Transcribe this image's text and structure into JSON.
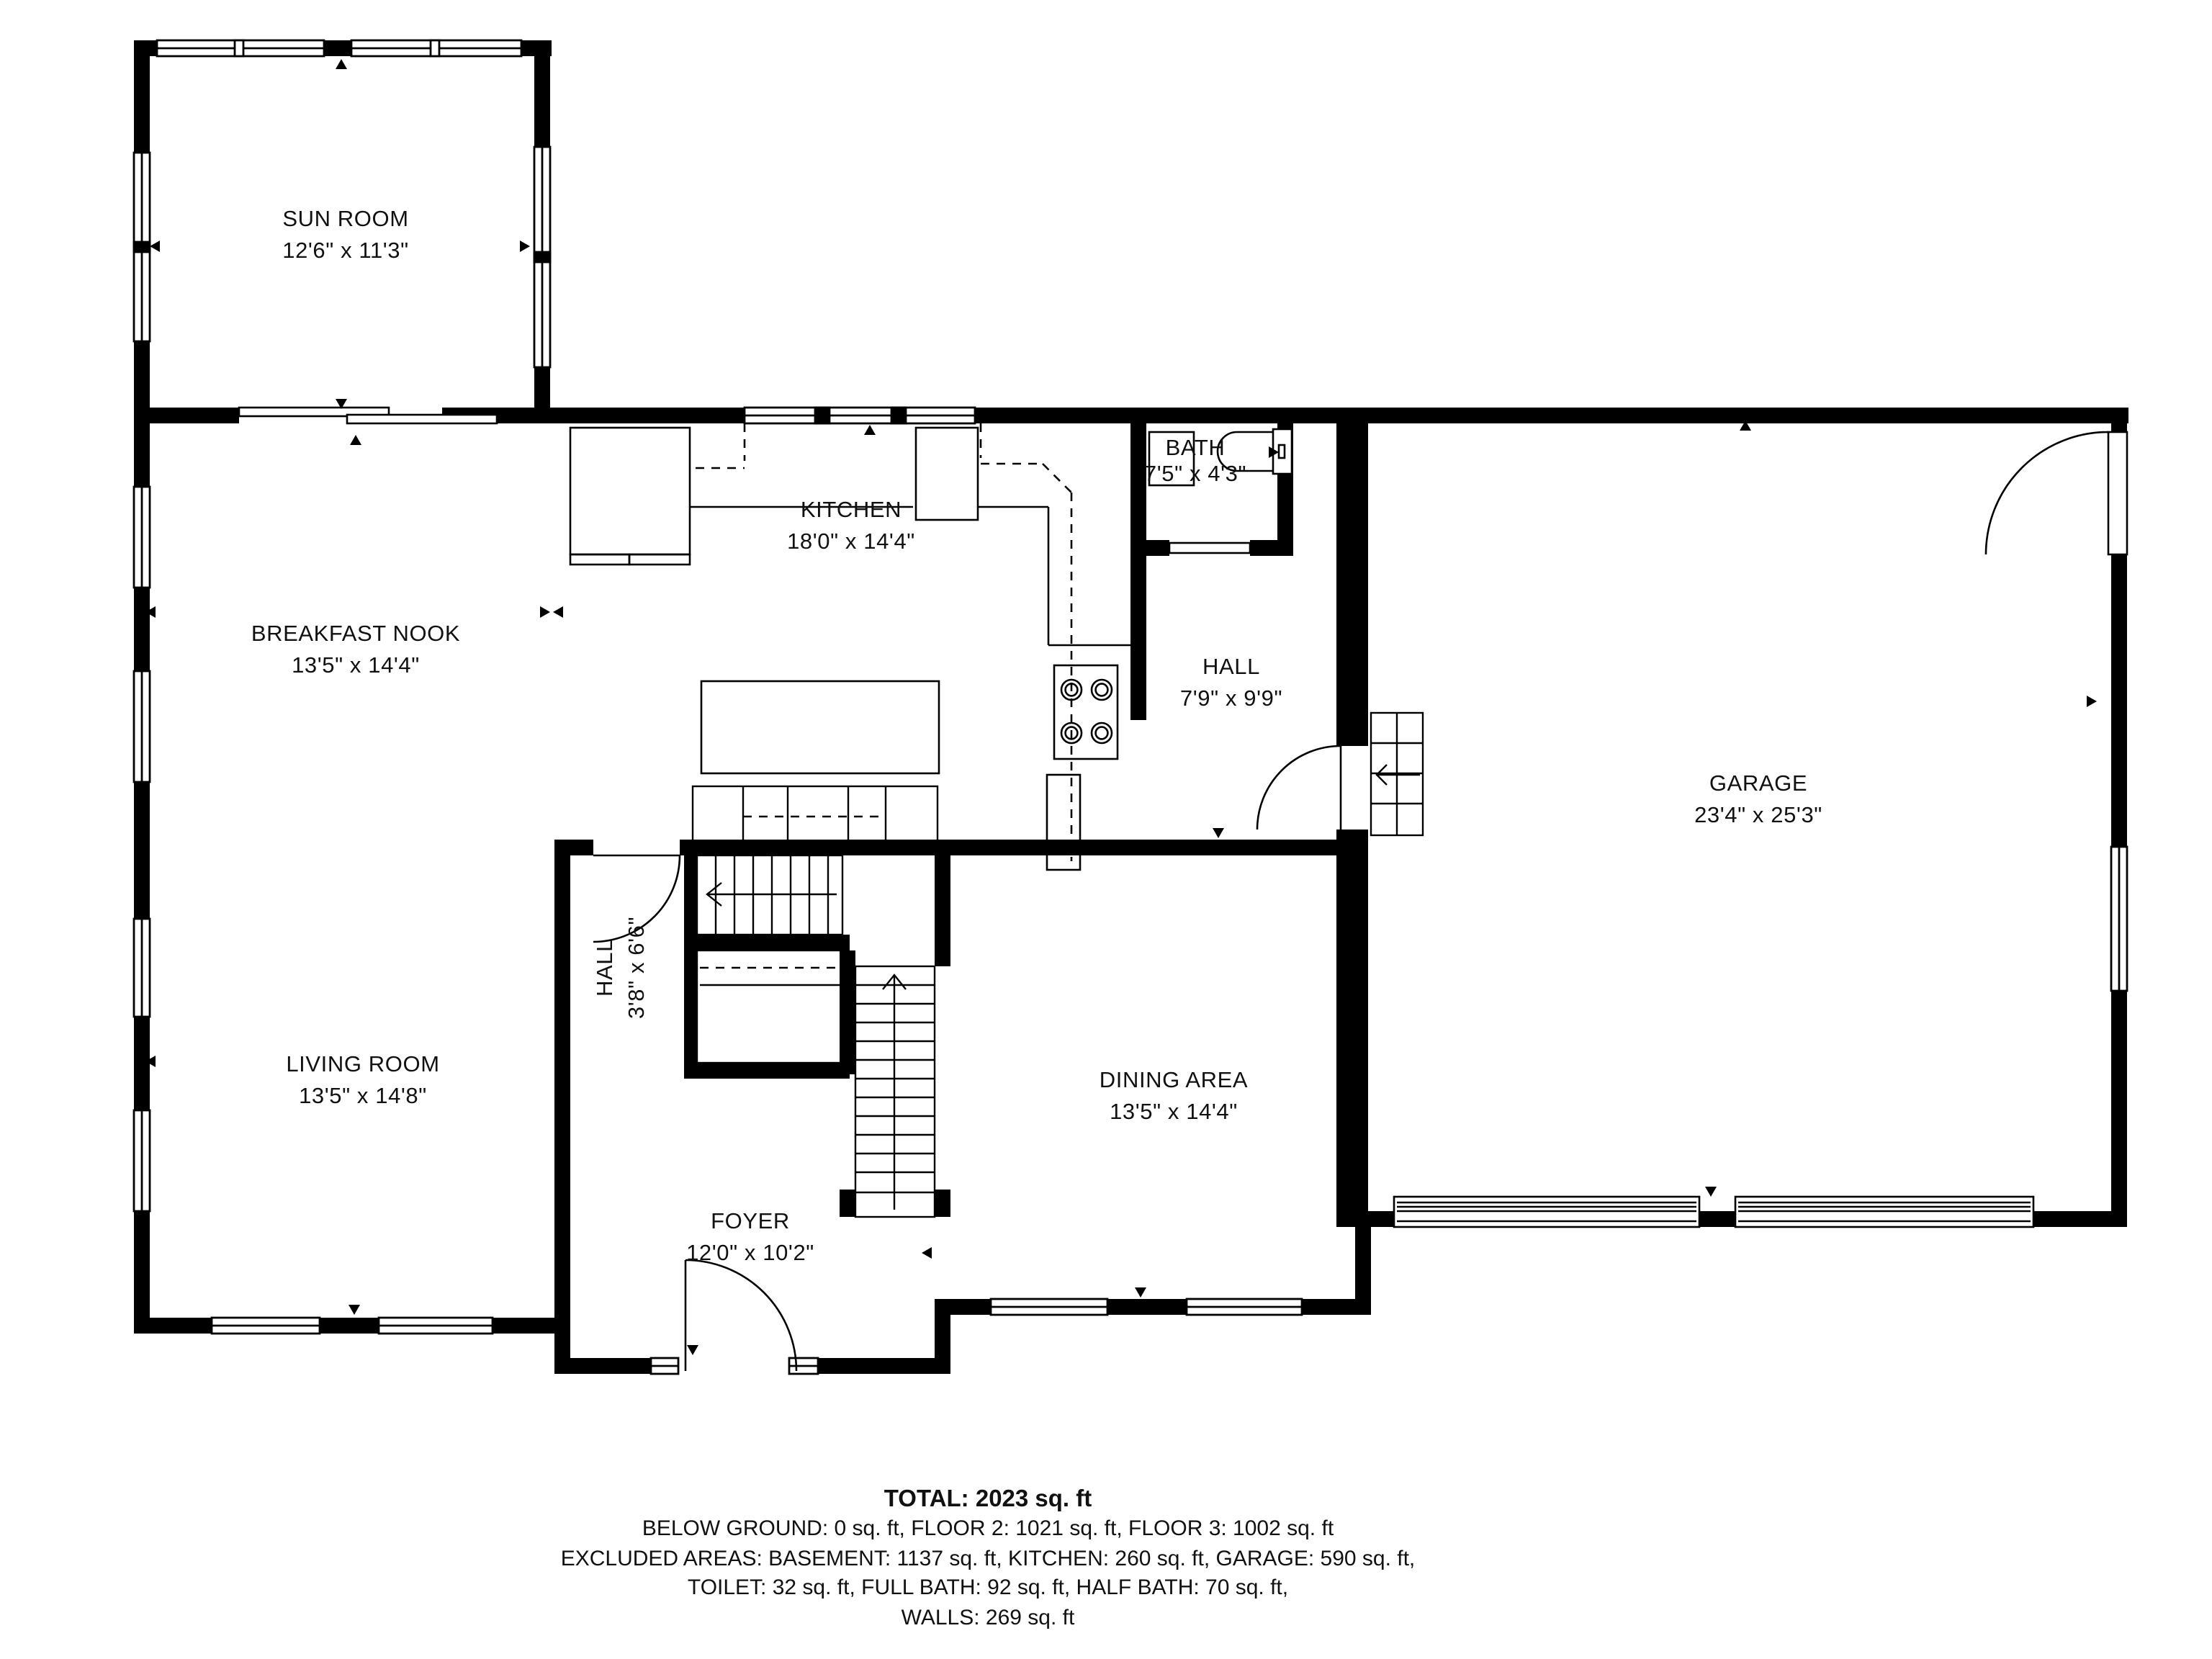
{
  "meta": {
    "app_name": "CubiCasa floor plan",
    "background_color": "#ffffff",
    "wall_color": "#000000",
    "text_color": "#111111"
  },
  "rooms": [
    {
      "id": "sun-room",
      "name": "SUN ROOM",
      "dims": "12'6\" x 11'3\""
    },
    {
      "id": "kitchen",
      "name": "KITCHEN",
      "dims": "18'0\" x 14'4\""
    },
    {
      "id": "bath",
      "name": "BATH",
      "dims": "7'5\" x 4'3\""
    },
    {
      "id": "breakfast-nook",
      "name": "BREAKFAST NOOK",
      "dims": "13'5\" x 14'4\""
    },
    {
      "id": "hall-upper",
      "name": "HALL",
      "dims": "7'9\" x 9'9\""
    },
    {
      "id": "garage",
      "name": "GARAGE",
      "dims": "23'4\" x 25'3\""
    },
    {
      "id": "living-room",
      "name": "LIVING ROOM",
      "dims": "13'5\" x 14'8\""
    },
    {
      "id": "hall-small",
      "name": "HALL",
      "dims": "3'8\" x 6'6\""
    },
    {
      "id": "dining-area",
      "name": "DINING AREA",
      "dims": "13'5\" x 14'4\""
    },
    {
      "id": "foyer",
      "name": "FOYER",
      "dims": "12'0\" x 10'2\""
    }
  ],
  "summary": {
    "total": "TOTAL: 2023 sq. ft",
    "line1": "BELOW GROUND: 0 sq. ft, FLOOR 2: 1021 sq. ft, FLOOR 3: 1002 sq. ft",
    "line2": "EXCLUDED AREAS: BASEMENT: 1137 sq. ft, KITCHEN: 260 sq. ft, GARAGE: 590 sq. ft,",
    "line3": "TOILET: 32 sq. ft, FULL BATH: 92 sq. ft, HALF BATH: 70 sq. ft,",
    "line4": "WALLS: 269 sq. ft",
    "disclaimer": "FLOOR PLAN CREATED BY CUBICASA APP. MEASUREMENTS DEEMED HIGHLY RELIABLE BUT NOT GUARANTEED."
  }
}
